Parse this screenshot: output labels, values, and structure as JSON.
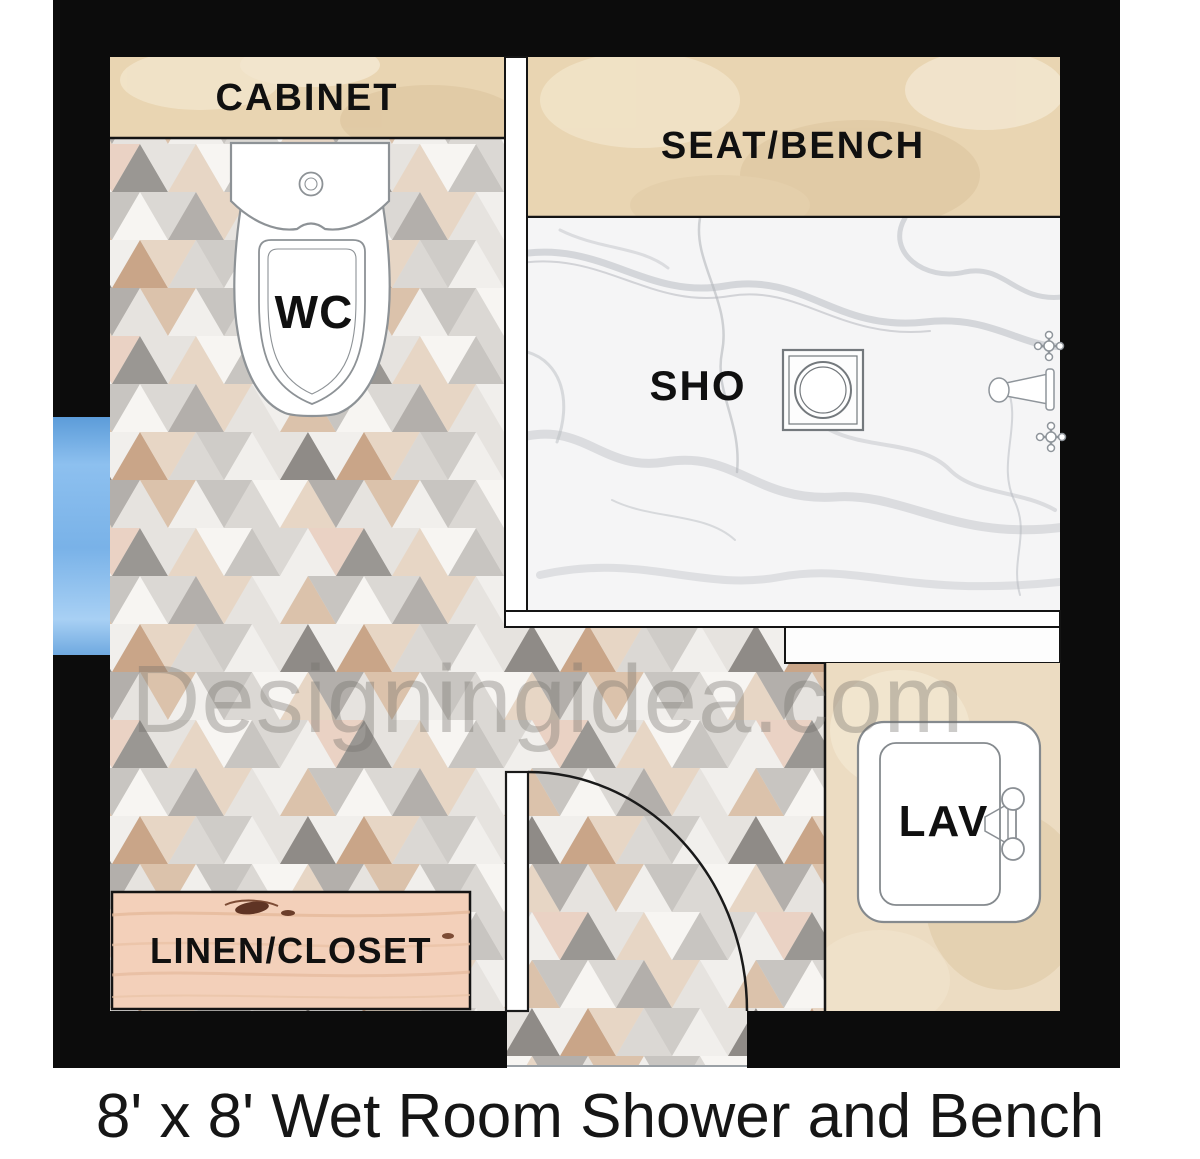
{
  "page": {
    "caption": "8' x 8' Wet Room Shower and Bench",
    "watermark": "Designingidea.com"
  },
  "plan": {
    "areas": {
      "cabinet": "CABINET",
      "seat_bench": "SEAT/BENCH",
      "shower": "SHO",
      "toilet": "WC",
      "lavatory": "LAV",
      "linen_closet": "LINEN/CLOSET"
    }
  },
  "colors": {
    "wall": "#0c0c0c",
    "beige_tile": "#e9d5b2",
    "beige_tile_light": "#ecdcc2",
    "marble_floor": "#f5f5f6",
    "mosaic_floor_base": "#e8e5e1",
    "wood": "#f3d0ba",
    "window_glass": "#85b9ec",
    "label_text": "#101010"
  }
}
